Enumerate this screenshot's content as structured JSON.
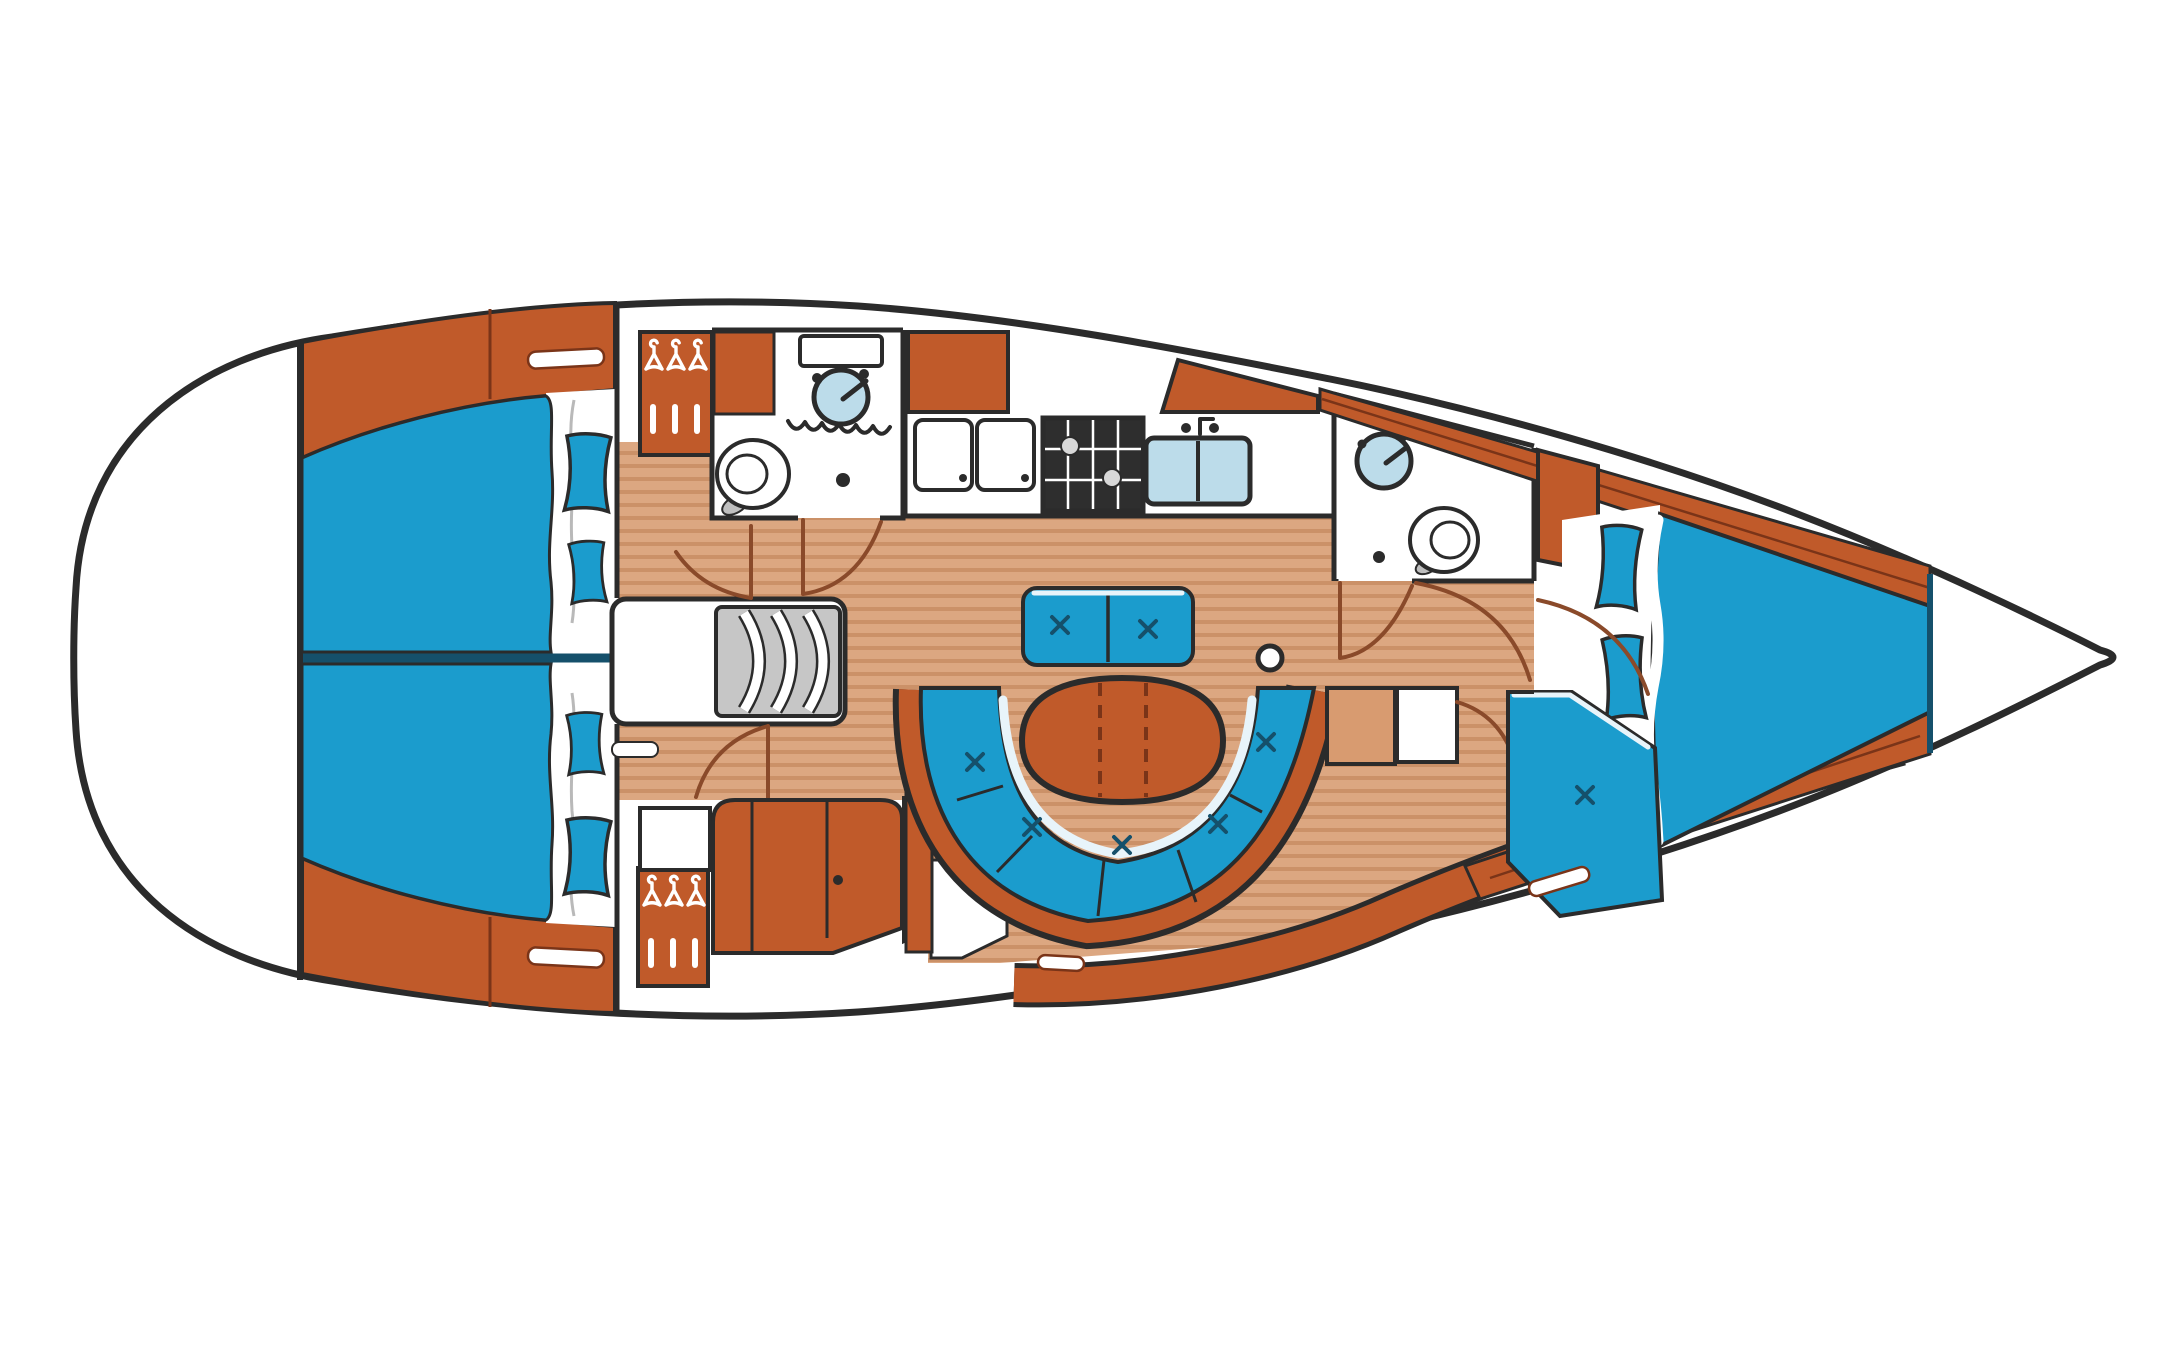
{
  "diagram": {
    "type": "boat-floor-plan",
    "subject": "Sailing yacht interior layout plan, top-down view, bow to the right",
    "orientation": {
      "bow": "right",
      "stern": "left",
      "port": "top",
      "starboard": "bottom"
    }
  },
  "colors": {
    "paper": "#ffffff",
    "outline": "#2b2b2b",
    "navy": "#15506b",
    "orange": "#c05a2a",
    "orange_dark": "#7a3418",
    "arc_brown": "#8a4a2a",
    "blue": "#1b9ccd",
    "floor": "#dca781",
    "floor_stripe": "#cb9168",
    "tan_light": "#d89b70",
    "sink_blue": "#bcdcea",
    "steps_gray": "#c6c6c6",
    "stove_dark": "#2e2e2e",
    "steel": "#bfbfbf",
    "sheet_gray": "#b9b9b9",
    "highlight": "#e8f4fa"
  },
  "areas": [
    {
      "id": "stern-lazarette",
      "label": "stern / transom (empty deck)"
    },
    {
      "id": "aft-cabin-port",
      "label": "aft double cabin, port side"
    },
    {
      "id": "aft-cabin-starboard",
      "label": "aft double cabin, starboard side"
    },
    {
      "id": "companionway-steps",
      "label": "companionway steps / engine box"
    },
    {
      "id": "aft-head",
      "label": "aft head with washbasin and toilet"
    },
    {
      "id": "hanging-lockers",
      "label": "hanging wardrobes with clothes hangers"
    },
    {
      "id": "galley",
      "label": "galley with stove, double sink and icebox lids"
    },
    {
      "id": "saloon",
      "label": "saloon with folding table, U-settee and bench"
    },
    {
      "id": "nav-seat",
      "label": "starboard cabinet / seat unit"
    },
    {
      "id": "forward-head",
      "label": "forward head with washbasin and toilet"
    },
    {
      "id": "forward-cabin",
      "label": "forward cabin with V-berth and seat"
    },
    {
      "id": "bow-locker",
      "label": "bow anchor locker (empty)"
    },
    {
      "id": "mast-post",
      "label": "mast post in saloon sole"
    }
  ]
}
